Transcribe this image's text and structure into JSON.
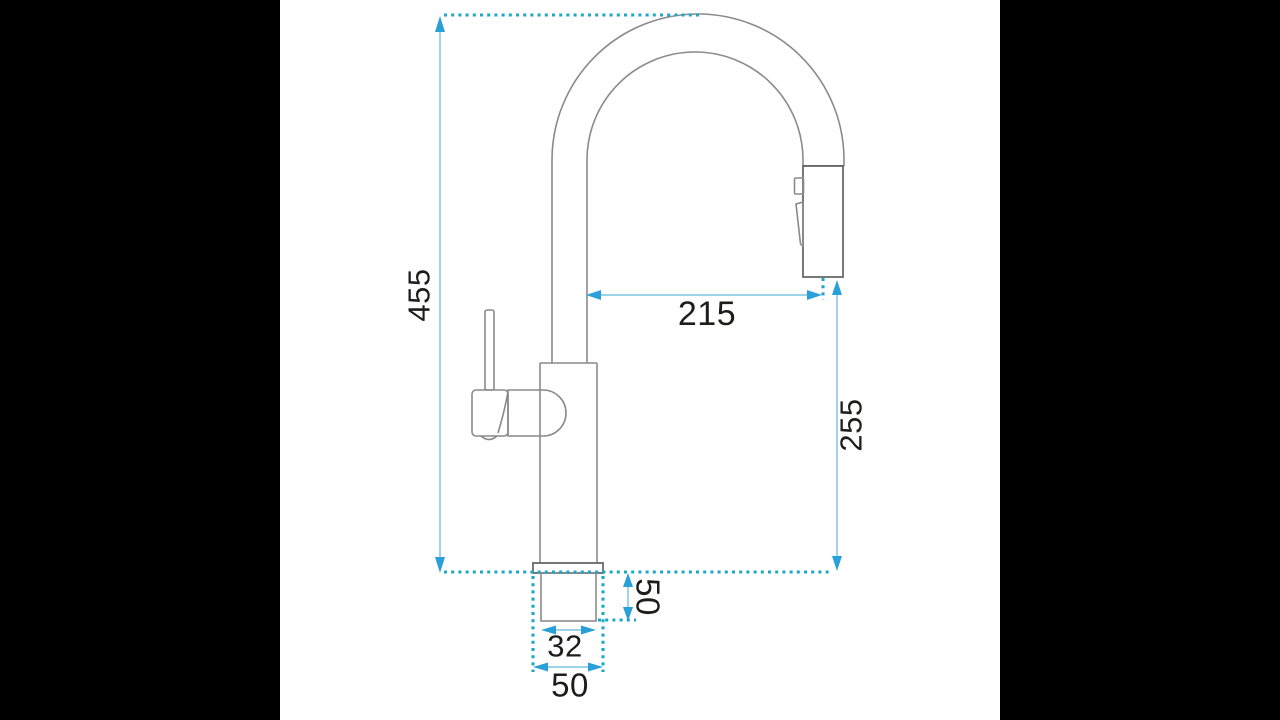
{
  "diagram": {
    "kind": "technical-dimension-drawing",
    "subject": "kitchen pull-down faucet, side view"
  },
  "dimensions": {
    "overall_height": "455",
    "spout_reach": "215",
    "outlet_height": "255",
    "thread_length": "50",
    "thread_diameter": "32",
    "base_diameter": "50"
  },
  "colors": {
    "background": "#000000",
    "canvas": "#ffffff",
    "drawing_line": "#8a8a8a",
    "drawing_dark": "#606060",
    "dim_line": "#8fcbe8",
    "arrow": "#2aa0d8",
    "guide_dotted": "#1ea6c9",
    "label_text": "#1d1d1b"
  }
}
